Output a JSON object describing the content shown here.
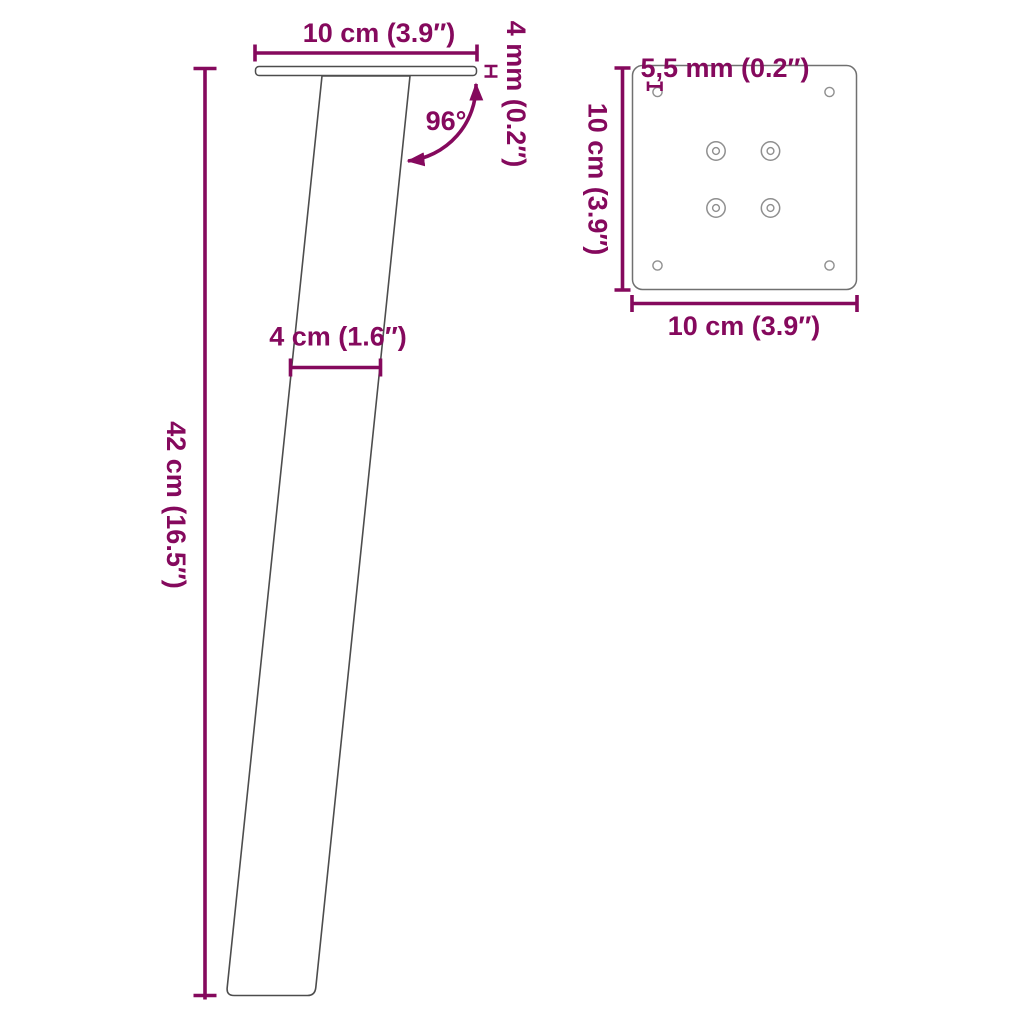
{
  "colors": {
    "accent": "#85095d",
    "leg-outline": "#4d4d4d",
    "plate-outline": "#707070",
    "hole-outline": "#8f8f8f"
  },
  "side_view": {
    "plate_width_label": "10 cm (3.9″)",
    "plate_thickness_label": "4 mm (0.2″)",
    "angle_label": "96°",
    "leg_width_label": "4 cm (1.6″)",
    "leg_height_label": "42 cm (16.5″)"
  },
  "top_view": {
    "hole_diameter_label": "5,5 mm (0.2″)",
    "plate_depth_label": "10 cm (3.9″)",
    "plate_width_label": "10 cm (3.9″)"
  }
}
